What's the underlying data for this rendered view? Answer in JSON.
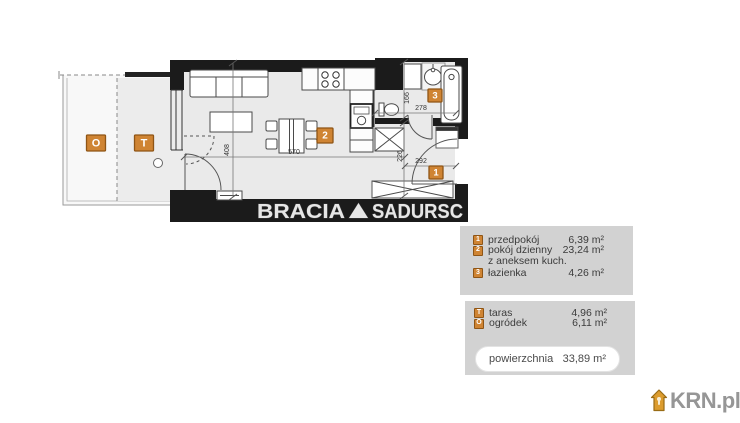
{
  "floorplan": {
    "watermark": {
      "part1": "BRACIA",
      "part2": "SADURSC"
    },
    "room_markers": {
      "garden": "O",
      "terrace": "T",
      "living": "2",
      "bathroom": "3",
      "hall": "1"
    },
    "dimensions": {
      "living_height": "408",
      "living_width": "570",
      "bath_height": "166",
      "bath_width": "278",
      "hall_height": "226",
      "hall_width": "292"
    },
    "colors": {
      "wall": "#1b1b1b",
      "floor": "#eaeaea",
      "marker": "#cf8433",
      "marker_border": "#8f5515"
    }
  },
  "legend": {
    "rooms": [
      {
        "marker": "1",
        "label": "przedpokój",
        "area": "6,39 m²"
      },
      {
        "marker": "2",
        "label": "pokój dzienny",
        "area": "23,24 m²"
      },
      {
        "marker": "",
        "label": "z aneksem kuch.",
        "area": ""
      },
      {
        "marker": "3",
        "label": "łazienka",
        "area": "4,26 m²"
      }
    ],
    "outdoor": [
      {
        "marker": "T",
        "label": "taras",
        "area": "4,96 m²"
      },
      {
        "marker": "O",
        "label": "ogródek",
        "area": "6,11 m²"
      }
    ],
    "total": {
      "label": "powierzchnia",
      "value": "33,89 m²"
    }
  },
  "branding": {
    "logo": "KRN.pl"
  }
}
